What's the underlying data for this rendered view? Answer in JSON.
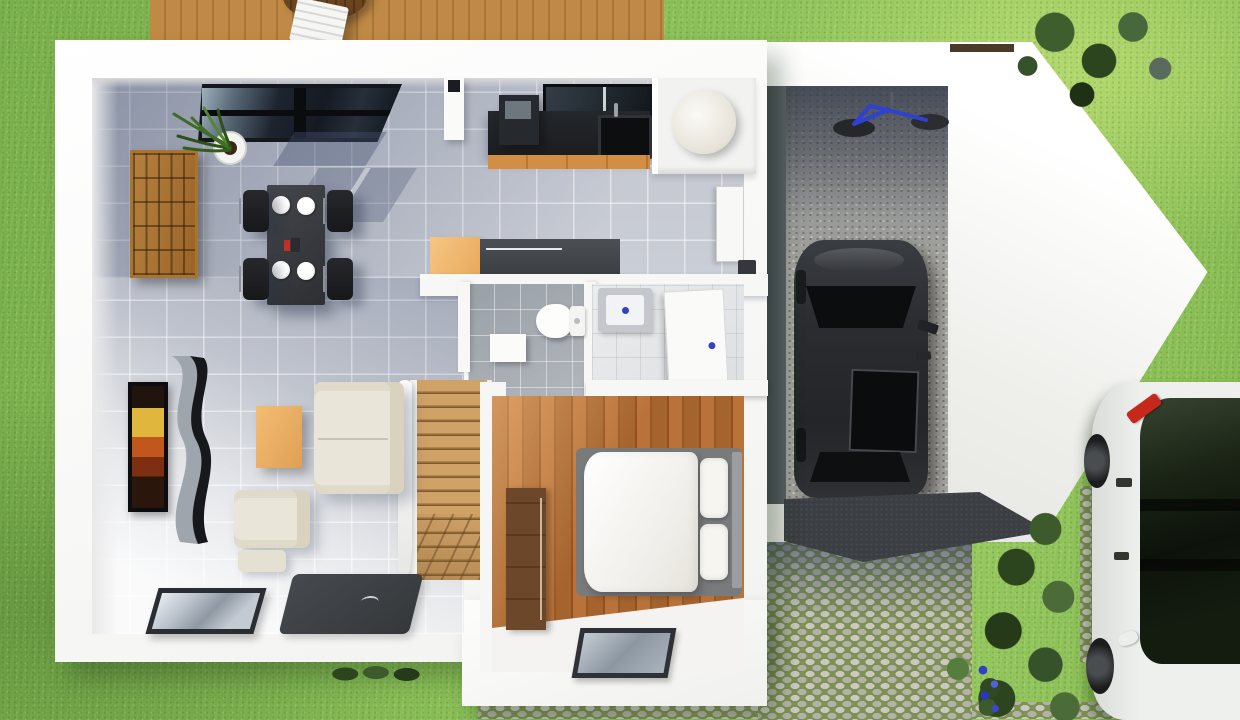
{
  "scene": {
    "kind": "3d-architectural-floor-plan-render",
    "view": "top-down aerial",
    "description": "Ground floor of a modern detached house with attached pointed garage, lawn, wooden deck, cobblestone driveway and parked cars"
  },
  "palette": {
    "grass": "#83b84f",
    "grassLight": "#9bcb63",
    "wallWhite": "#f6f6f5",
    "tileShadow": "#aab0bf",
    "tileLight": "#d9dce1",
    "deckWood": "#bb8543",
    "bedroomWood": "#a5632d",
    "stairWood": "#cfa268",
    "counterDark": "#212429",
    "cabinetWood": "#d28e42",
    "furnitureCream": "#e9e5d8",
    "rugDark": "#35383b",
    "carBlack": "#27292d",
    "carWhite": "#eef0ee",
    "accentRed": "#c6281c",
    "bikeBlue": "#2f41d0",
    "cobbleStone": "#c9c9c1",
    "cobbleJoint": "#7f9152",
    "hedgeGreen": "#35522a",
    "glassDark": "#1d242e",
    "doorHandleBlue": "#3240c4"
  },
  "rooms": [
    {
      "name": "living-dining-room",
      "floor": "grey ceramic tiles with sunlight patch",
      "furniture": [
        "dining-table",
        "dining-chair x4",
        "white-plate x4",
        "candle-set",
        "cube-storage-shelf",
        "potted-plant",
        "orange-sideboard",
        "dark-island-counter",
        "cream-sofa",
        "cream-armchair",
        "ottoman",
        "wooden-coffee-table",
        "wall-tv-abstract-art",
        "curved-media-unit",
        "dark-rug",
        "glass-floor-panel",
        "inclined-roof-window"
      ]
    },
    {
      "name": "kitchen",
      "furniture": [
        "black-countertop",
        "inset-sink",
        "faucet",
        "coffee-machine",
        "wood-front-cabinets",
        "kitchen-window",
        "white-pillar"
      ]
    },
    {
      "name": "utility-room",
      "furniture": [
        "water-heater-cylinder"
      ]
    },
    {
      "name": "hallway",
      "furniture": [
        "entry-door",
        "wall-slot"
      ]
    },
    {
      "name": "wc",
      "floor": "grey tiles",
      "furniture": [
        "toilet",
        "small-sink"
      ]
    },
    {
      "name": "bathroom",
      "floor": "white tiles",
      "furniture": [
        "vanity-sink-blue-drain",
        "door-with-blue-handle"
      ]
    },
    {
      "name": "staircase",
      "furniture": [
        "wooden-steps",
        "winder-steps",
        "white-railing"
      ]
    },
    {
      "name": "bedroom",
      "floor": "warm wooden planks",
      "furniture": [
        "double-bed-white-duvet",
        "pillow x2",
        "grey-bed-frame",
        "dark-wardrobe",
        "floor-skylight"
      ]
    },
    {
      "name": "garage",
      "floor": "speckled concrete",
      "furniture": [
        "black-car-top-view",
        "wall-mounted-blue-bicycle",
        "dark-garage-door-slab"
      ]
    }
  ],
  "exterior": [
    "lawn-grass",
    "wooden-deck",
    "white-deck-chair",
    "round-deck-table",
    "cobblestone-driveway",
    "cobblestone-walkway",
    "cobblestone-parking-pad",
    "hedge-bushes-right",
    "bush-top-right",
    "hedge-strip-bottom",
    "blue-flowers",
    "white-car-with-red-roof-accent",
    "pointed-garage-outer-wall"
  ],
  "counts": {
    "dining_chairs": 4,
    "plates": 4,
    "pillows": 2,
    "cars": 2,
    "bicycles": 1
  }
}
